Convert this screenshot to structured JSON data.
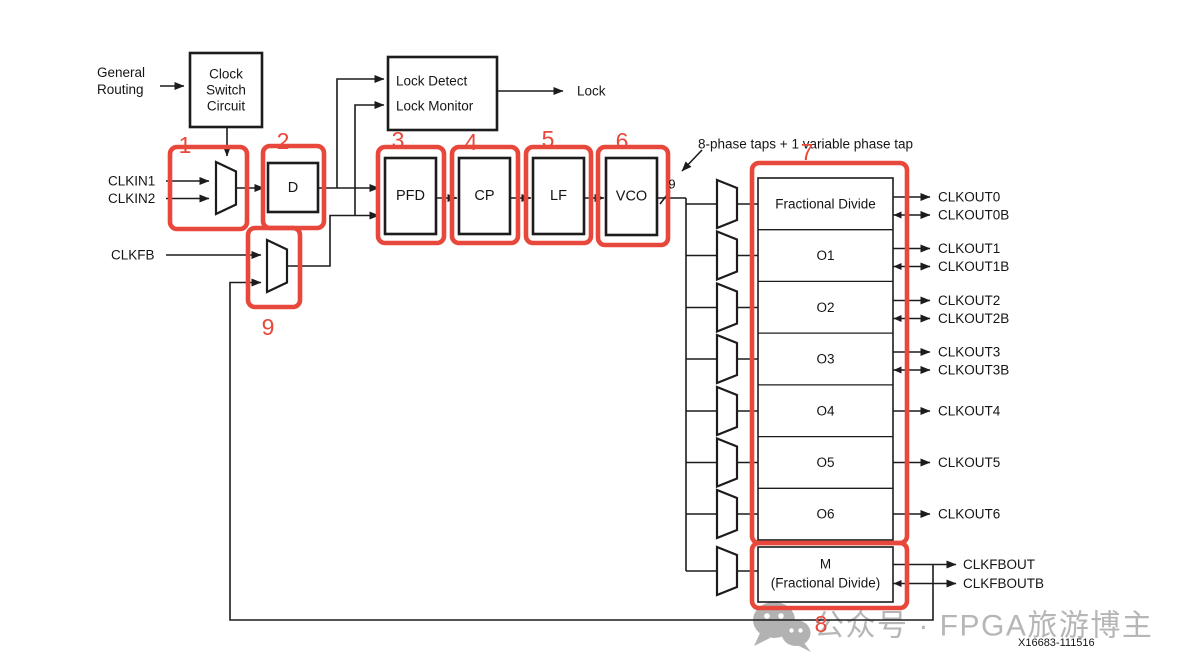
{
  "colors": {
    "annotation_red": "#e8483c",
    "line_ink": "#1c1c1c",
    "watermark_gray": "#b6b6b6"
  },
  "inputs": {
    "general_routing": [
      "General",
      "Routing"
    ],
    "clkin1": "CLKIN1",
    "clkin2": "CLKIN2",
    "clkfb": "CLKFB"
  },
  "blocks": {
    "clock_switch": [
      "Clock",
      "Switch",
      "Circuit"
    ],
    "d_divider": "D",
    "lock_detect": [
      "Lock Detect",
      "Lock Monitor"
    ],
    "pfd": "PFD",
    "cp": "CP",
    "lf": "LF",
    "vco": "VCO",
    "output_dividers": [
      "Fractional Divide",
      "O1",
      "O2",
      "O3",
      "O4",
      "O5",
      "O6"
    ],
    "m_divider": [
      "M",
      "(Fractional Divide)"
    ]
  },
  "outputs": {
    "lock": "Lock",
    "clkouts": [
      "CLKOUT0",
      "CLKOUT0B",
      "CLKOUT1",
      "CLKOUT1B",
      "CLKOUT2",
      "CLKOUT2B",
      "CLKOUT3",
      "CLKOUT3B",
      "CLKOUT4",
      "CLKOUT5",
      "CLKOUT6"
    ],
    "clkfbout": "CLKFBOUT",
    "clkfboutb": "CLKFBOUTB"
  },
  "annotations": {
    "phase_taps": "8-phase taps + 1 variable phase tap",
    "vco_bus_width": "9",
    "markers": [
      "1",
      "2",
      "3",
      "4",
      "5",
      "6",
      "7",
      "8",
      "9"
    ],
    "figure_id": "X16683-111516"
  },
  "watermark": {
    "text": "公众号 · FPGA旅游博主"
  }
}
